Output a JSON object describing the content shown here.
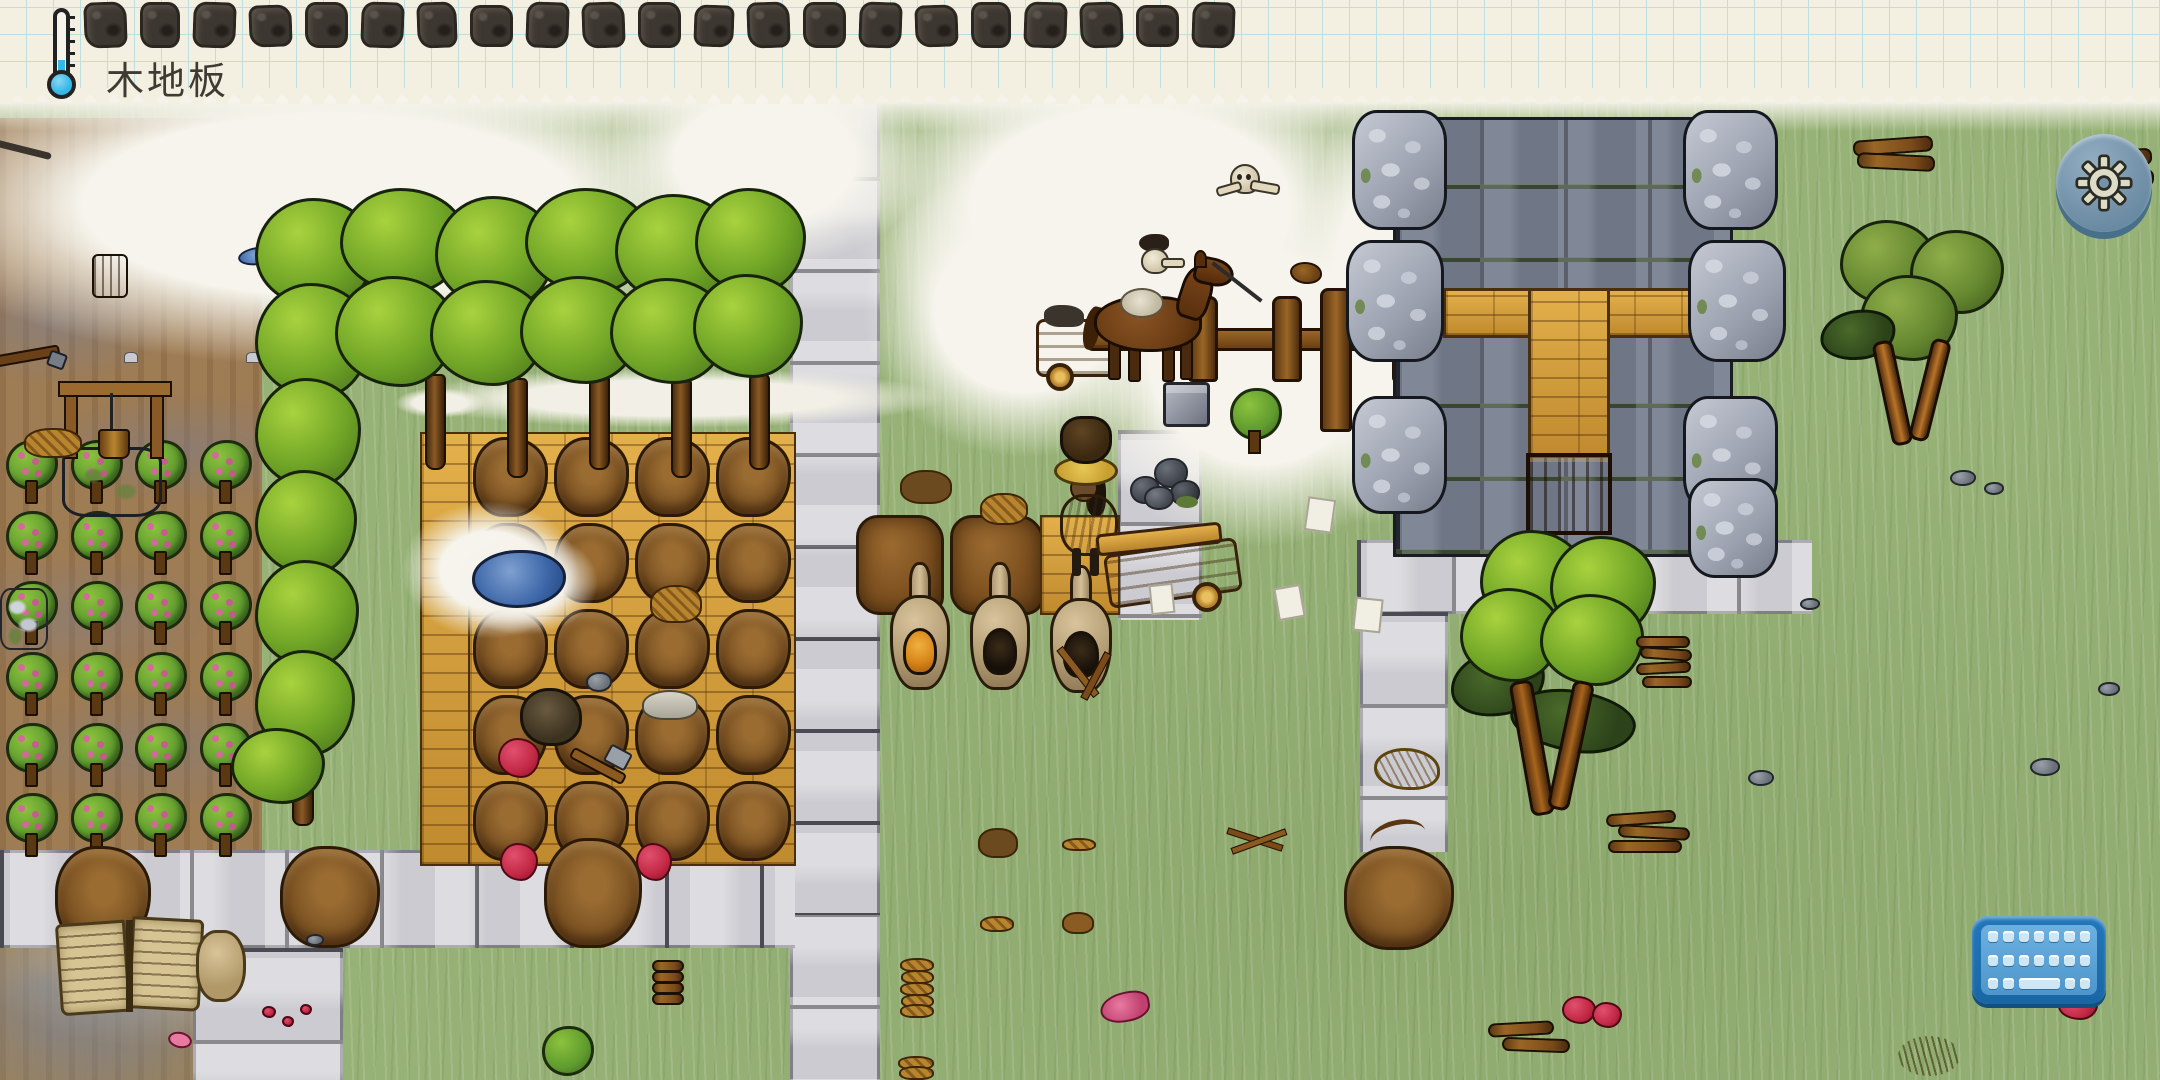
{
  "hud": {
    "caption": "木地板",
    "thermometer": {
      "icon": "thermometer-icon",
      "state": "cold"
    },
    "hotbar": {
      "description": "sketched-object-hint-icons",
      "slots": [
        {
          "icon": "sketch-item-icon"
        },
        {
          "icon": "sketch-item-icon"
        },
        {
          "icon": "sketch-item-icon"
        },
        {
          "icon": "sketch-item-icon"
        },
        {
          "icon": "sketch-item-icon"
        },
        {
          "icon": "sketch-item-icon"
        },
        {
          "icon": "sketch-item-icon"
        },
        {
          "icon": "sketch-item-icon"
        },
        {
          "icon": "sketch-item-icon"
        },
        {
          "icon": "sketch-item-icon"
        },
        {
          "icon": "sketch-item-icon"
        },
        {
          "icon": "sketch-item-icon"
        },
        {
          "icon": "sketch-item-icon"
        },
        {
          "icon": "sketch-item-icon"
        },
        {
          "icon": "sketch-item-icon"
        },
        {
          "icon": "sketch-item-icon"
        },
        {
          "icon": "sketch-item-icon"
        },
        {
          "icon": "sketch-item-icon"
        },
        {
          "icon": "sketch-item-icon"
        },
        {
          "icon": "sketch-item-icon"
        },
        {
          "icon": "sketch-item-icon"
        }
      ]
    },
    "settings_button": {
      "icon": "gear-icon"
    },
    "keyboard_button": {
      "icon": "keyboard-icon",
      "key_rows": {
        "row1": 7,
        "row2": 7
      }
    }
  },
  "world": {
    "berry_bush_count": 24,
    "pelt_grid_count": 20,
    "entities": [
      "well",
      "berry-farm",
      "tree-grove",
      "bear-pelt-grid",
      "wooden-floor",
      "stone-road",
      "adobe-wall",
      "adobe-kiln",
      "firing-kiln",
      "player-character",
      "hand-cart",
      "horse-with-cart",
      "wooden-fence",
      "skeleton",
      "horse-skull",
      "stone-block",
      "stone-fortress",
      "wooden-door",
      "olive-tree",
      "firewood-pile",
      "open-book",
      "pond",
      "paper-sheet",
      "plate-stack"
    ]
  },
  "colors": {
    "paper": "#f3f0e1",
    "grid": "#bcdfe1",
    "ink": "#3f3a33",
    "grass": "#97b277",
    "soil": "#9e7c54",
    "road": "#cbcbd1",
    "stonewall": "#6f7685",
    "cobble": "#b2b7c2",
    "wood": "#d9a544",
    "tree": "#6fa426",
    "adobe": "#7a4e1e",
    "pelt": "#7b5222",
    "uiblue": "#2277bb",
    "gearbtn": "#7392aa",
    "cold": "#35b8e8"
  }
}
